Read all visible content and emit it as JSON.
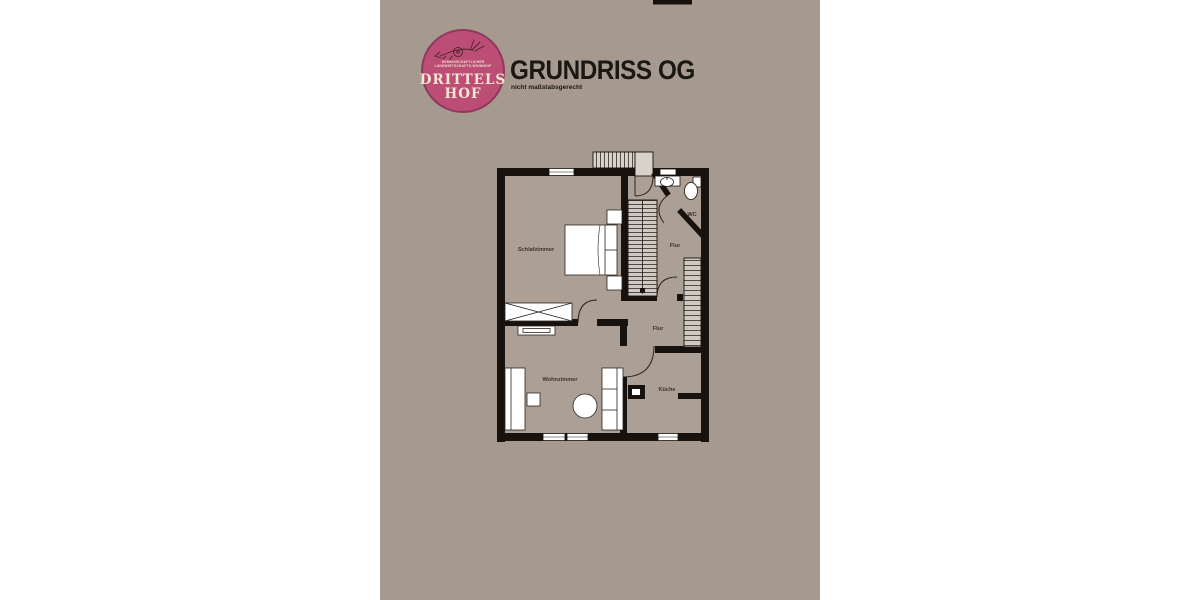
{
  "header": {
    "title": "GRUNDRISS OG",
    "subtitle": "nicht maßstabsgerecht"
  },
  "logo": {
    "name_line1": "DRITTELS",
    "name_line2": "HOF",
    "micro_line1": "GEMEINSCHAFTLICHER",
    "micro_line2": "LANDWIRTSCHAFTS-WOHNHOF"
  },
  "rooms": {
    "bedroom": "Schlafzimmer",
    "living": "Wohnzimmer",
    "kitchen": "Küche",
    "hall_upper": "Flur",
    "hall_lower": "Flur",
    "wc": "WC"
  },
  "colors": {
    "panel_bg": "#a69a90",
    "room_fill": "#aca096",
    "wall": "#17120e",
    "logo_pink": "#bc4d75",
    "logo_ring": "#8e3a5e",
    "logo_cream": "#f3e6d1",
    "title_color": "#1b1712"
  }
}
